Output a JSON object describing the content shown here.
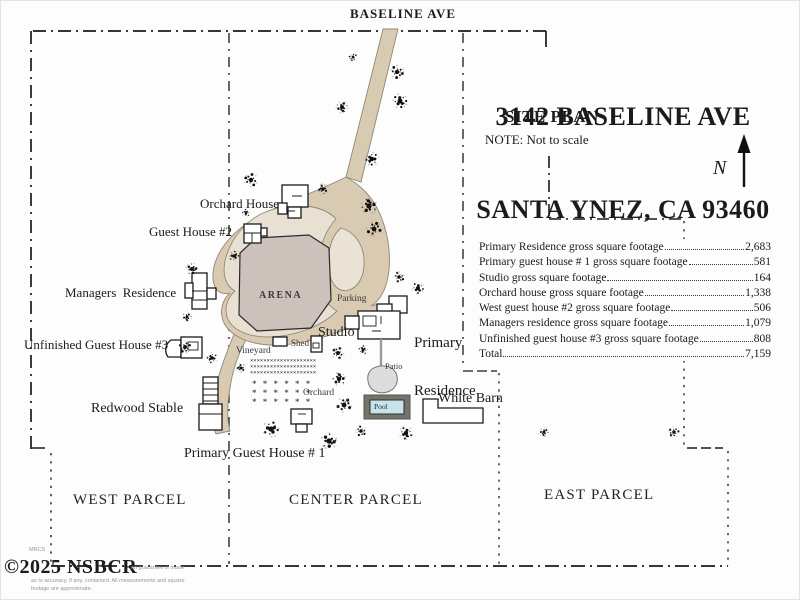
{
  "street": {
    "label": "BASELINE AVE"
  },
  "title_block": {
    "address_line1": "3142 BASELINE AVE",
    "address_line2": "SANTA YNEZ, CA 93460",
    "plan_title": "SITE PLAN",
    "note": "NOTE: Not to scale",
    "north_label": "N"
  },
  "sqft_table": {
    "rows": [
      {
        "label": "Primary Residence gross square footage",
        "value": "2,683"
      },
      {
        "label": "Primary guest house # 1 gross square footage",
        "value": "581"
      },
      {
        "label": "Studio gross square footage",
        "value": "164"
      },
      {
        "label": "Orchard house gross square footage",
        "value": "1,338"
      },
      {
        "label": "West guest house #2 gross square footage",
        "value": "506"
      },
      {
        "label": "Managers residence gross square footage",
        "value": "1,079"
      },
      {
        "label": "Unfinished guest house #3 gross square footage",
        "value": "808"
      },
      {
        "label": "Total",
        "value": "7,159"
      }
    ]
  },
  "map_labels": {
    "orchard_house": "Orchard House",
    "guest_house_2": "Guest House #2",
    "managers_residence": "Managers  Residence",
    "unfinished_guest_house_3": "Unfinished Guest House #3",
    "redwood_stable": "Redwood Stable",
    "primary_guest_house_1": "Primary Guest House # 1",
    "arena": "ARENA",
    "parking": "Parking",
    "studio": "Studio",
    "shed": "Shed",
    "vineyard": "Vineyard",
    "orchard": "Orchard",
    "patio": "Patio",
    "pool": "Pool",
    "primary_residence_line1": "Primary",
    "primary_residence_line2": "Residence",
    "white_barn": "White Barn"
  },
  "parcels": {
    "west": "WEST PARCEL",
    "center": "CENTER PARCEL",
    "east": "EAST PARCEL"
  },
  "watermark": {
    "tiny_top": "MRCS",
    "brand": "©2025 NSBCR",
    "disclaimer_line1": "no guarantee is made",
    "disclaimer_line2": "as to accuracy, if any, contained. All measurements and square",
    "disclaimer_line3": "footage are approximate."
  },
  "colors": {
    "road": "#d9cab2",
    "pad": "#e9e0d4",
    "arena": "#cdc1bc",
    "patio": "#dcdcdc",
    "pool_deck": "#74746c",
    "pool_water": "#c9e4e8",
    "line": "#1a1a1a"
  }
}
